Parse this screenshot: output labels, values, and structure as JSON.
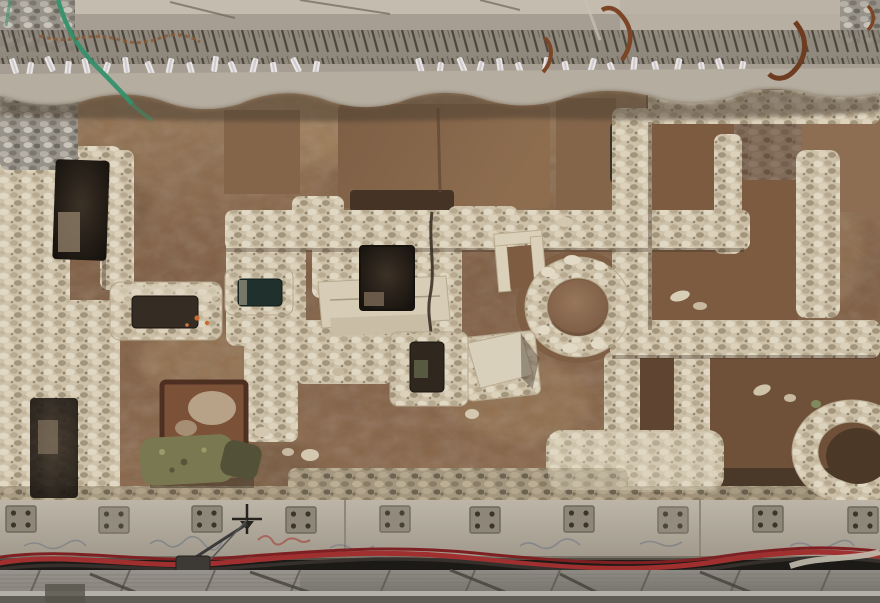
{
  "meta": {
    "type": "photograph",
    "alt": "Top-down aerial view of an archaeological excavation trench beneath a modern building: ancient rubble stone walls, plastered basins, a deep square pit, a circular stone installation and earthen floors, framed above by a concrete capping beam with exposed rebar, white survey tags, a green hose and rusted tie hooks, and below by a concrete waler beam with steel anchor plates, a survey cross mark, red and black power cables, a junction box and grey steel decking."
  },
  "palette": {
    "concrete_base": "#a69e92",
    "concrete_edge": "#c4bcae",
    "ledge": "#b5ad9f",
    "overhang_shadow": "#4e3f33",
    "earth_light": "#9a7a58",
    "earth_mid": "#8a684a",
    "earth_dark": "#6b4c35",
    "earth_deep": "#4a3828",
    "stone_cream": "#cdc1a9",
    "stone_bright": "#e0d6c0",
    "stone_shadow": "#a3977f",
    "pit_dark": "#1f1a14",
    "room_brown": "#7c5b41",
    "room_brown2": "#84654a",
    "basin_teal": "#20302c",
    "moss_green": "#7a7850",
    "maroon_frame": "#7b5137",
    "rust": "#7c4526",
    "hose_green": "#35906b",
    "tag_white": "#e9e6e3",
    "beam_concrete": "#b1aa9d",
    "plate_gray": "#8e8779",
    "bolt_dark": "#3b352c",
    "cable_red": "#a03030",
    "cable_red_dark": "#7e2022",
    "cable_black": "#35302c",
    "junction_box": "#3d3a36",
    "deck_gray": "#8e8b85",
    "deck_dark": "#5f5c55",
    "deck_rail": "#b3b0aa",
    "orange_fleck": "#c96a2f"
  },
  "scene": {
    "top_beam_label": "modern concrete capping beam with exposed rebar spikes, white survey tags, green hose and rusted tie hooks",
    "excavation_label": "excavated archaeological remains with rubble stone walls and earthen floors",
    "bottom_structure_label": "concrete waler beam with anchor plates, survey cross, power cables and steel decking",
    "features": [
      {
        "name": "left-sunken-room",
        "desc": "dark rectangular sunken room at left"
      },
      {
        "name": "stone-trough",
        "desc": "rectangular stone trough with dark slot and orange flecks"
      },
      {
        "name": "small-basin",
        "desc": "stone basin with dark teal interior"
      },
      {
        "name": "central-pit",
        "desc": "deep dark square pit in stone platform"
      },
      {
        "name": "stone-platform",
        "desc": "smooth rectangular stone slab platform"
      },
      {
        "name": "door-frame",
        "desc": "small U-shaped stone frame"
      },
      {
        "name": "round-installation",
        "desc": "circular stone ring with earthen dome center"
      },
      {
        "name": "pedestal",
        "desc": "square stone pedestal with tilted capstone"
      },
      {
        "name": "slot-basin",
        "desc": "stone block with rectangular dark slot"
      },
      {
        "name": "right-room",
        "desc": "large room outlined by rubble walls"
      },
      {
        "name": "lower-ring",
        "desc": "partially visible stone ring at lower right"
      },
      {
        "name": "moss-stone",
        "desc": "moss covered stone block"
      },
      {
        "name": "maroon-hearth",
        "desc": "red-brown framed rectangular feature"
      }
    ]
  }
}
